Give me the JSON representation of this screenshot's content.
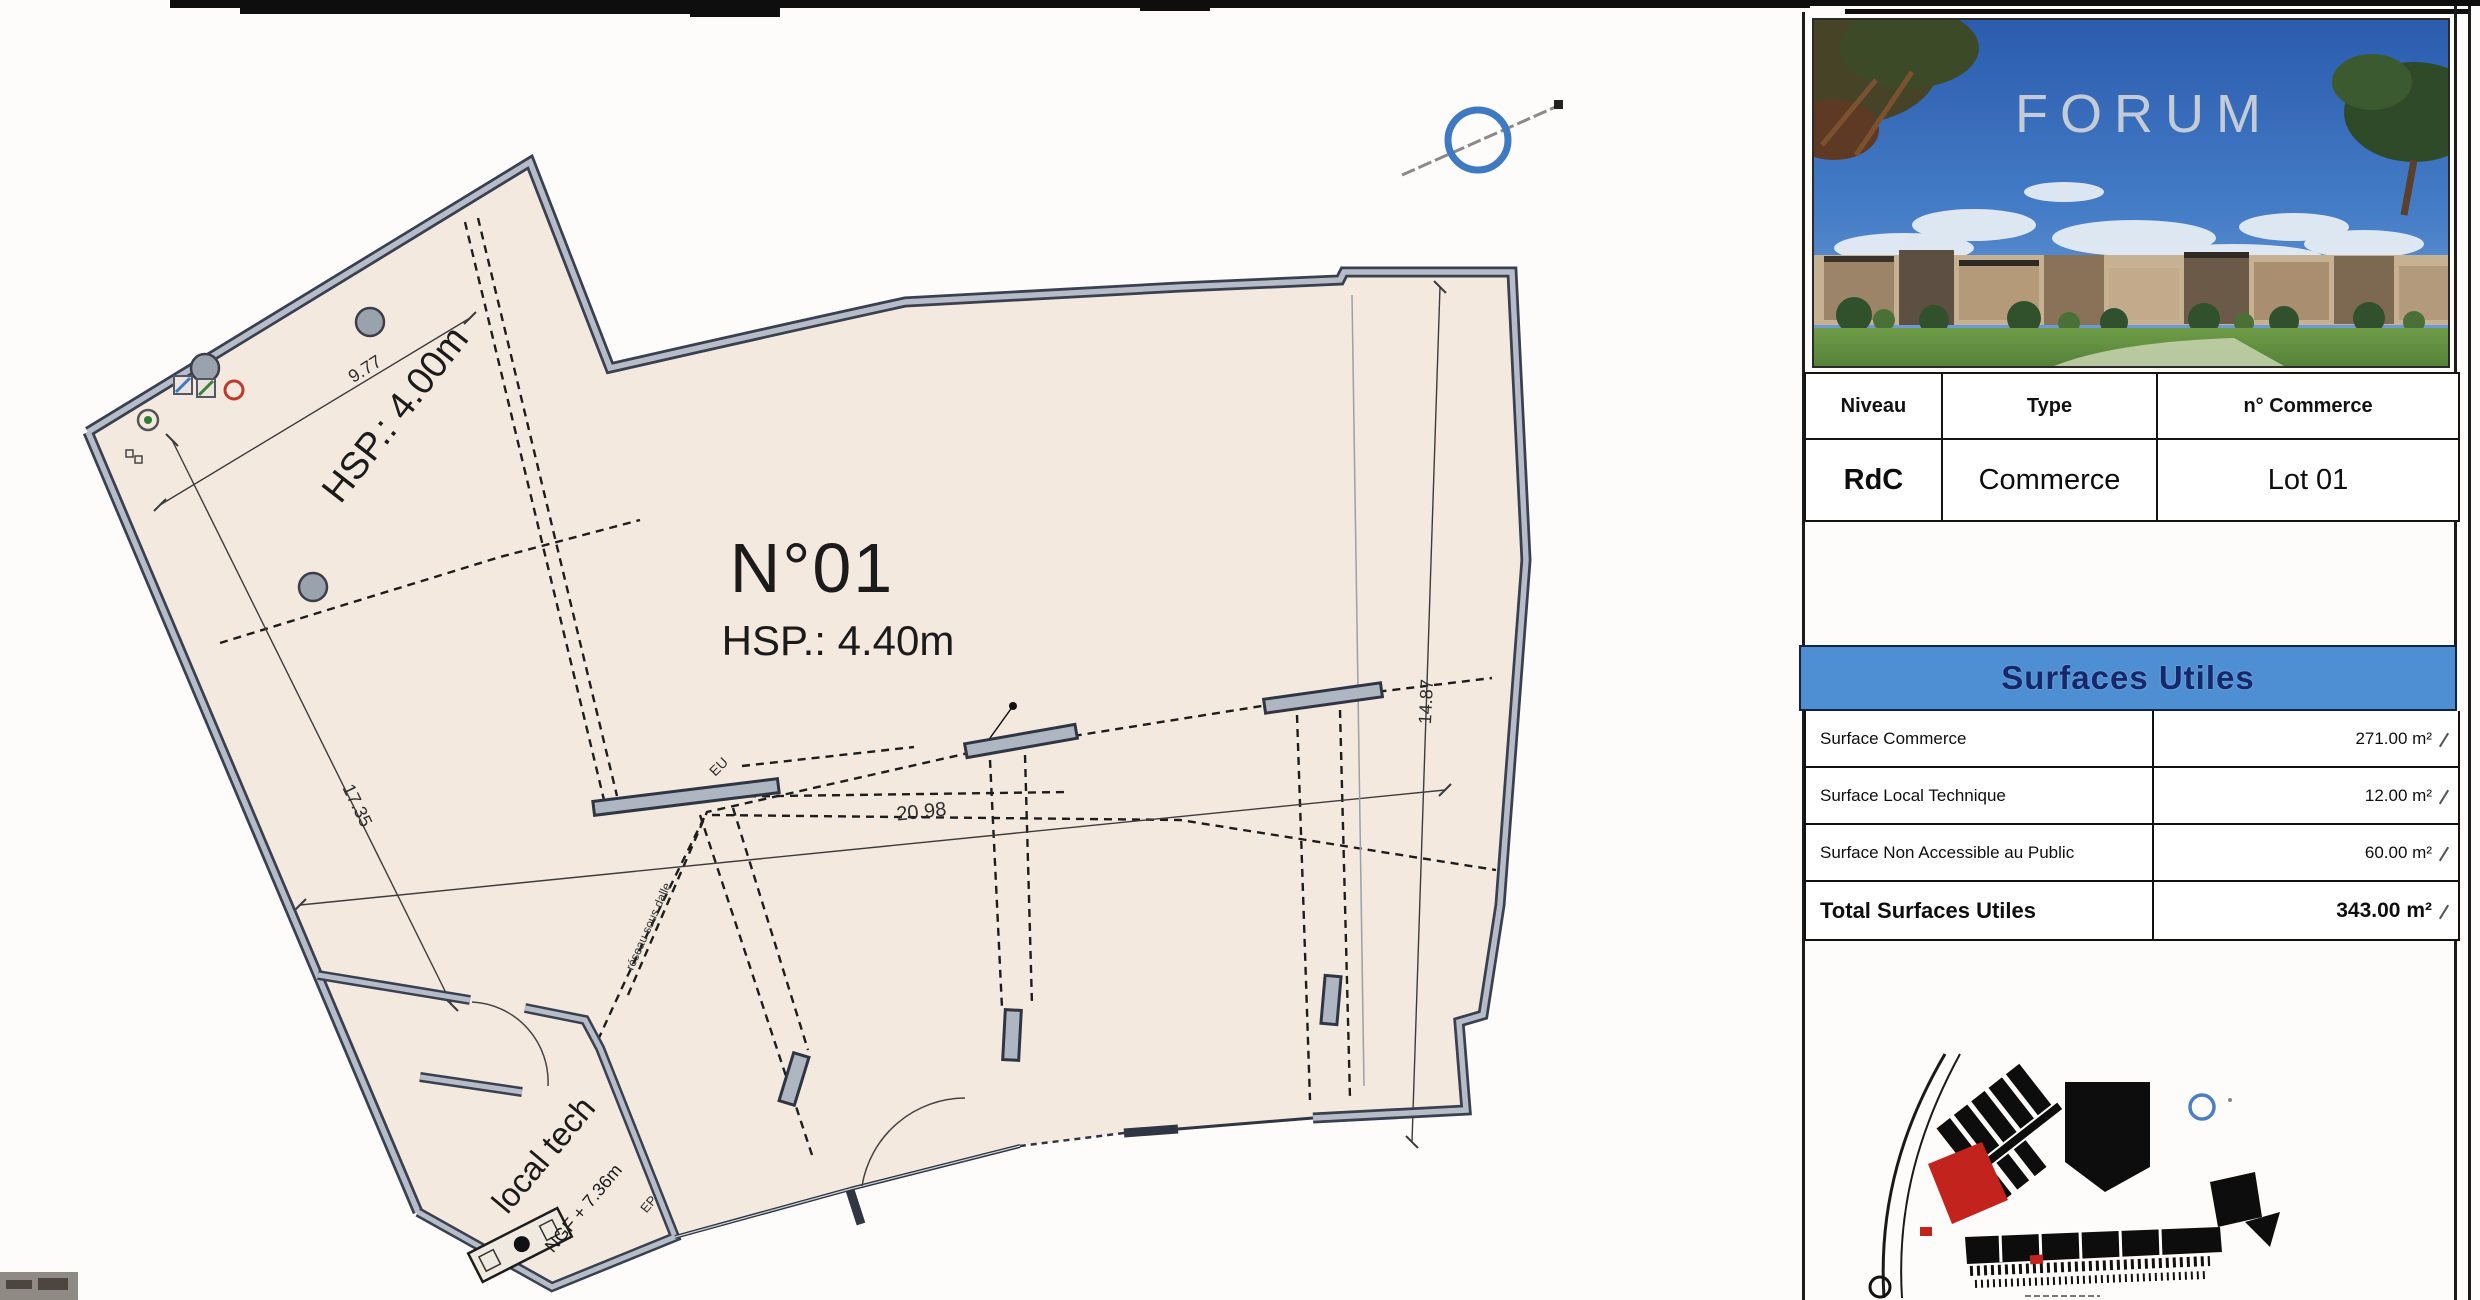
{
  "plan": {
    "unit_number": "N°01",
    "unit_height": "HSP.: 4.40m",
    "zone_height": "HSP.: 4.00m",
    "dim_top": "9.77",
    "dim_left": "17.35",
    "dim_width": "20.98",
    "dim_right": "14.87",
    "local_tech_label": "local tech",
    "local_tech_level": "NGF + 7.36m",
    "note_network": "réseau sous dalle",
    "label_eu": "EU",
    "label_ep": "EP",
    "colors": {
      "wall_dark": "#39404f",
      "wall_core": "#b6bdc8",
      "floor_fill": "#f4e9df",
      "north_blue": "#3e79c2"
    }
  },
  "title_block": {
    "logo_text": "FORUM",
    "info_table": {
      "col_niveau": "Niveau",
      "col_type": "Type",
      "col_commerce": "n° Commerce",
      "niveau": "RdC",
      "type": "Commerce",
      "commerce": "Lot 01"
    },
    "surfaces": {
      "title": "Surfaces Utiles",
      "rows": [
        {
          "label": "Surface Commerce",
          "value": "271.00 m²"
        },
        {
          "label": "Surface Local Technique",
          "value": "12.00 m²"
        },
        {
          "label": "Surface Non Accessible au Public",
          "value": "60.00 m²"
        }
      ],
      "total_label": "Total Surfaces Utiles",
      "total_value": "343.00 m²"
    }
  }
}
